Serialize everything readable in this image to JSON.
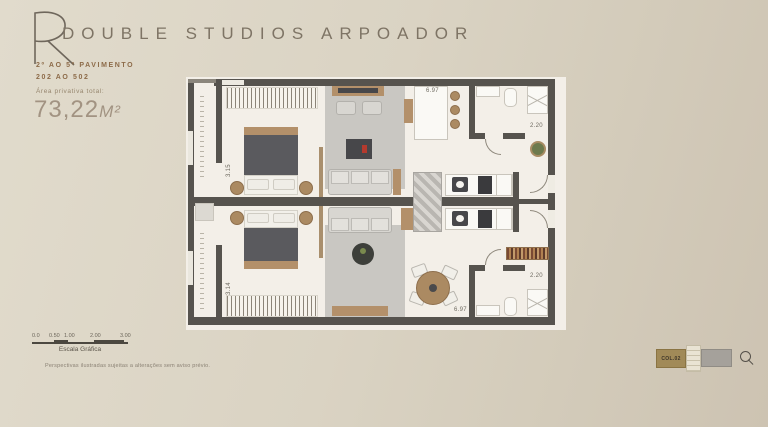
{
  "header": {
    "logo_letter": "R",
    "title": "DOUBLE STUDIOS ARPOADOR",
    "floor_range": "2º AO 5º PAVIMENTO",
    "unit_range": "202 AO 502",
    "area_label": "Área privativa total:",
    "area_value": "73,22",
    "area_unit": "M²"
  },
  "plan": {
    "dims": {
      "bedroom_top_height": "3.15",
      "bedroom_bottom_height": "3.14",
      "unit_top_width": "6.97",
      "unit_bottom_width": "6.97",
      "bath_top_width": "2.20",
      "bath_bottom_width": "2.20"
    }
  },
  "scale_bar": {
    "ticks": [
      "0.0",
      "0.50",
      "1.00",
      "2.00",
      "3.00"
    ],
    "label": "Escala Gráfica"
  },
  "footer": {
    "disclaimer": "Perspectivas ilustradas sujeitas a alterações sem aviso prévio."
  },
  "keyplan": {
    "unit_label": "COL.02"
  },
  "colors": {
    "background": "#dbd4c4",
    "wall": "#56534e",
    "accent_brown": "#8d6b49",
    "wood": "#b3906a"
  }
}
